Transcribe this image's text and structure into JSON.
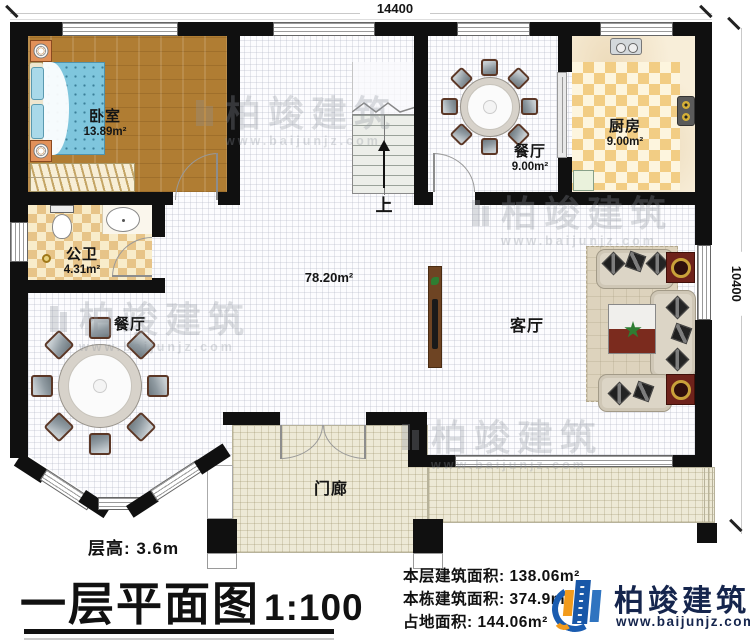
{
  "dimensions": {
    "width_label": "14400",
    "depth_label": "10400"
  },
  "plan": {
    "bedroom": {
      "label": "卧室",
      "area": "13.89m²"
    },
    "bathroom": {
      "label": "公卫",
      "area": "4.31m²"
    },
    "dining_left": {
      "label": "餐厅"
    },
    "dining_top": {
      "label": "餐厅",
      "area": "9.00m²"
    },
    "kitchen": {
      "label": "厨房",
      "area": "9.00m²"
    },
    "living": {
      "label": "客厅"
    },
    "hall": {
      "area": "78.20m²"
    },
    "porch": {
      "label": "门廊"
    },
    "stairs": {
      "label": "上"
    }
  },
  "titleblock": {
    "floor_height": "层高: 3.6m",
    "title": "一层平面图",
    "scale": "1:100",
    "floor_area": "本层建筑面积: 138.06m²",
    "total_area": "本栋建筑面积: 374.9m²",
    "footprint": "占地面积: 144.06m²"
  },
  "brand": {
    "name": "柏竣建筑",
    "website": "www.baijunjz.com"
  },
  "colors": {
    "wall": "#101010",
    "accent_blue": "#1a5cb0",
    "accent_orange": "#f29b1d",
    "brand_text": "#15254d"
  }
}
